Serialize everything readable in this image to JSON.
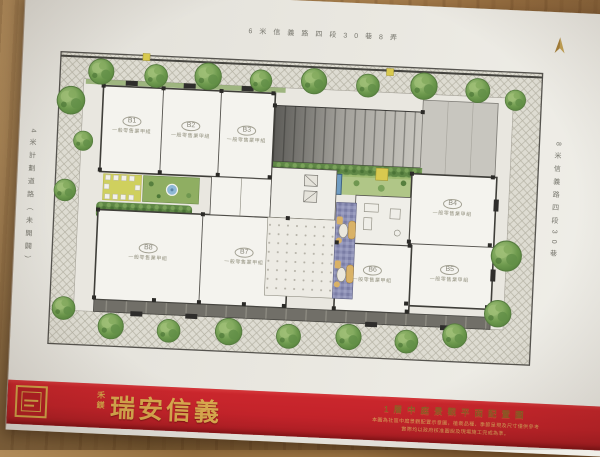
{
  "streets": {
    "top": "6米信義路四段30巷8弄",
    "bottom": "6米信義路四段30巷22弄",
    "left": "4米計劃道路（未開闢）",
    "right": "8米信義路四段30巷"
  },
  "plan": {
    "units": [
      {
        "id": "B1",
        "use": "一般零售業甲組"
      },
      {
        "id": "B2",
        "use": "一般零售業甲組"
      },
      {
        "id": "B3",
        "use": "一般零售業甲組"
      },
      {
        "id": "B4",
        "use": "一般零售業甲組"
      },
      {
        "id": "B5",
        "use": "一般零售業甲組"
      },
      {
        "id": "B6",
        "use": "一般零售業甲組"
      },
      {
        "id": "B7",
        "use": "一般零售業甲組"
      },
      {
        "id": "B8",
        "use": "一般零售業甲組"
      }
    ]
  },
  "banner": {
    "brand_side": "禾鎂",
    "brand": "瑞安信義",
    "title": "1層中庭景觀平面配置圖",
    "disclaimer1": "本圖為社區中庭景觀配置示意圖，植栽品種、季節呈現及尺寸僅供參考",
    "disclaimer2": "實際均以政府核准圖說及現場施工完成為準。"
  },
  "colors": {
    "banner_red": "#c3232a",
    "gold": "#d4a549",
    "paper": "#e9e7e0",
    "pool_blue": "#6f9cc2",
    "tree_green": "#6d9750"
  }
}
